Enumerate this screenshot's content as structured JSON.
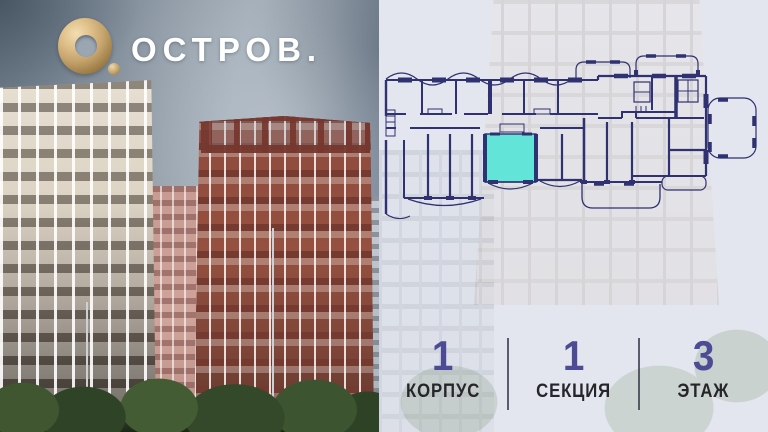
{
  "brand": {
    "name": "ОСТРОВ.",
    "logo_icon": "gold-ring-o-with-dot"
  },
  "colors": {
    "accent_teal": "#63e4d8",
    "plan_line": "#2f3170",
    "number_indigo": "#4c4b94",
    "label_dark": "#26262a",
    "panel_bg": "#e3e6ef",
    "logo_gold": "#c9a873"
  },
  "floorplan": {
    "name": "floor-plan-building-slab",
    "highlighted_unit_icon": "selected-apartment-teal"
  },
  "info": {
    "items": [
      {
        "value": "1",
        "label": "КОРПУС"
      },
      {
        "value": "1",
        "label": "СЕКЦИЯ"
      },
      {
        "value": "3",
        "label": "ЭТАЖ"
      }
    ]
  }
}
